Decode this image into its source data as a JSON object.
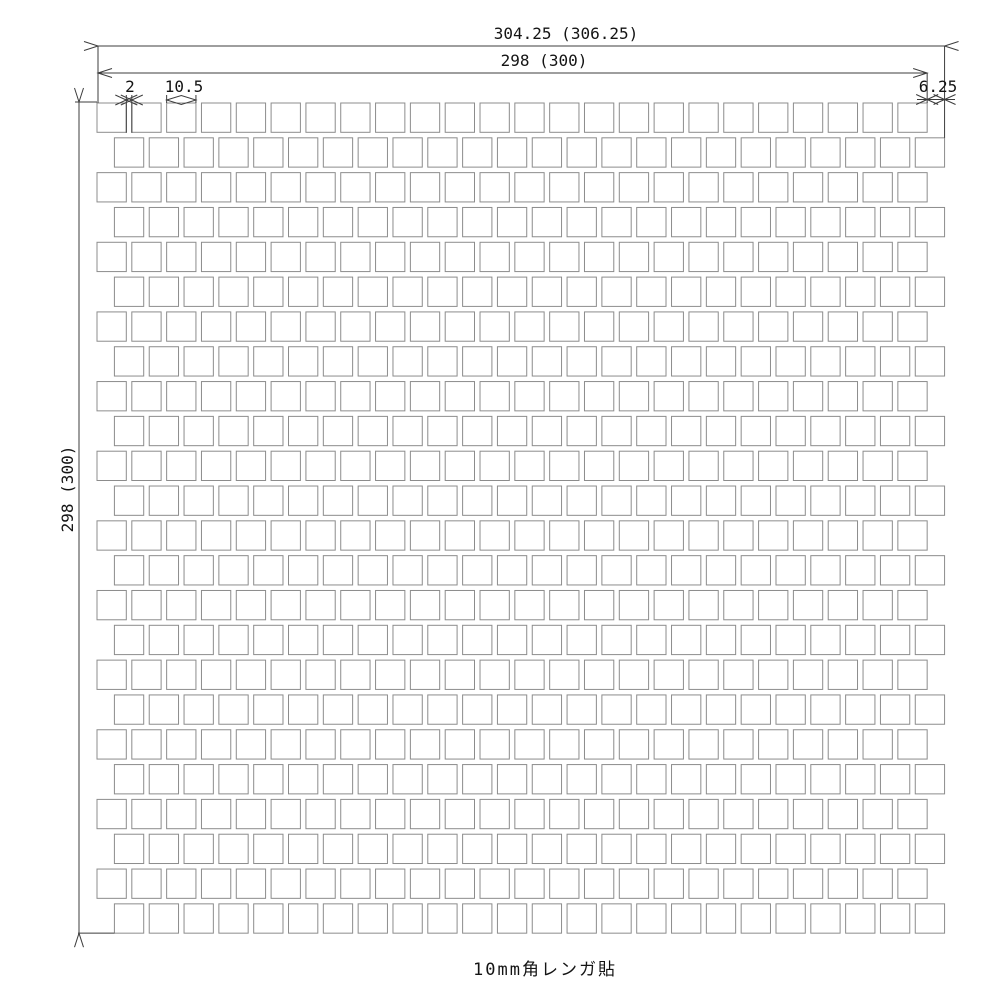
{
  "drawing": {
    "caption": "10mm角レンガ貼",
    "dims": {
      "total_width": "304.25 (306.25)",
      "sheet_width": "298 (300)",
      "sheet_height": "298 (300)",
      "joint_width": "2",
      "tile_size": "10.5",
      "row_offset": "6.25"
    },
    "grid": {
      "rows": 24,
      "cols": 24,
      "stagger": "even rows offset half pitch to the right"
    },
    "colors": {
      "background": "#ffffff",
      "tile_line": "#8c8c8c",
      "dimension_line": "#3c3c3c",
      "text": "#141414"
    }
  }
}
